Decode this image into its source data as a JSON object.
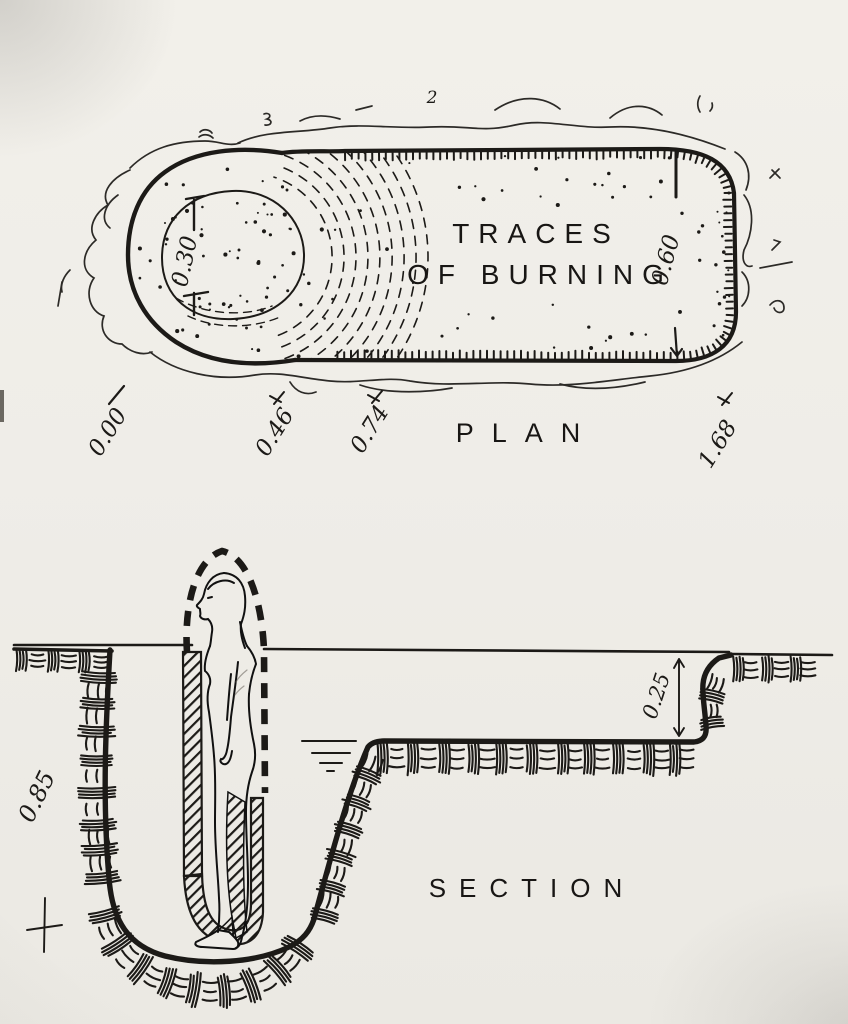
{
  "figure": {
    "plan": {
      "title": "PLAN",
      "interior_label_line1": "TRACES",
      "interior_label_line2": "OF BURNING",
      "dim_oval_height": "0.30",
      "dim_pit_width": "0.60",
      "baseline_labels": [
        "0.00",
        "0.46",
        "0.74",
        "1.68"
      ],
      "stray_numeral": "2"
    },
    "section": {
      "title": "SECTION",
      "dim_pit_depth": "0.85",
      "dim_shallow_depth": "0.25"
    },
    "colors": {
      "paper": "#efede8",
      "ink": "#1c1a17"
    }
  }
}
